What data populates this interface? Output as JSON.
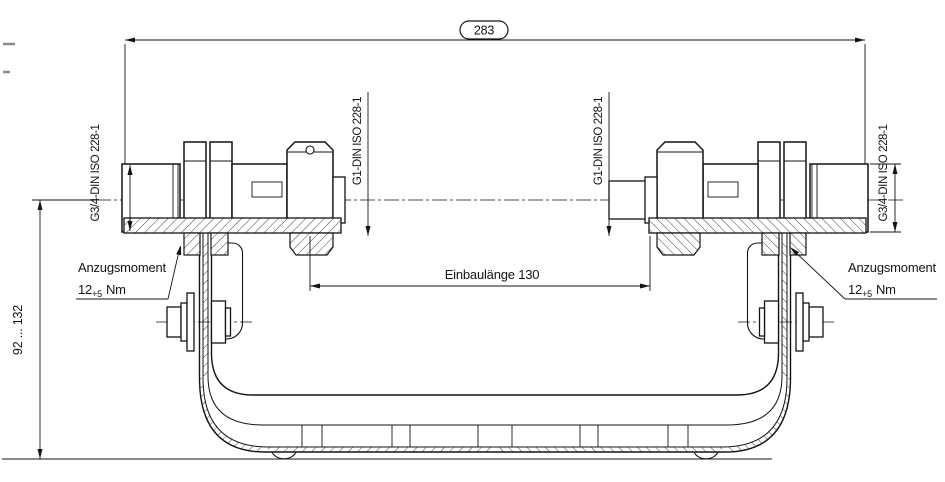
{
  "drawing": {
    "kind": "technical-drawing",
    "background": "#ffffff",
    "line_color": "#141414",
    "dimensions": {
      "overall_width": "283",
      "installation_length": "Einbaulänge 130",
      "height_range": "92 ... 132"
    },
    "thread_labels": {
      "outer_left": "G3/4-DIN ISO 228-1",
      "inner_left": "G1-DIN ISO 228-1",
      "inner_right": "G1-DIN ISO 228-1",
      "outer_right": "G3/4-DIN ISO 228-1"
    },
    "torque_left": {
      "title": "Anzugsmoment",
      "value": "12",
      "tolerance": "+5",
      "unit": "Nm"
    },
    "torque_right": {
      "title": "Anzugsmoment",
      "value": "12",
      "tolerance": "+5",
      "unit": "Nm"
    }
  }
}
